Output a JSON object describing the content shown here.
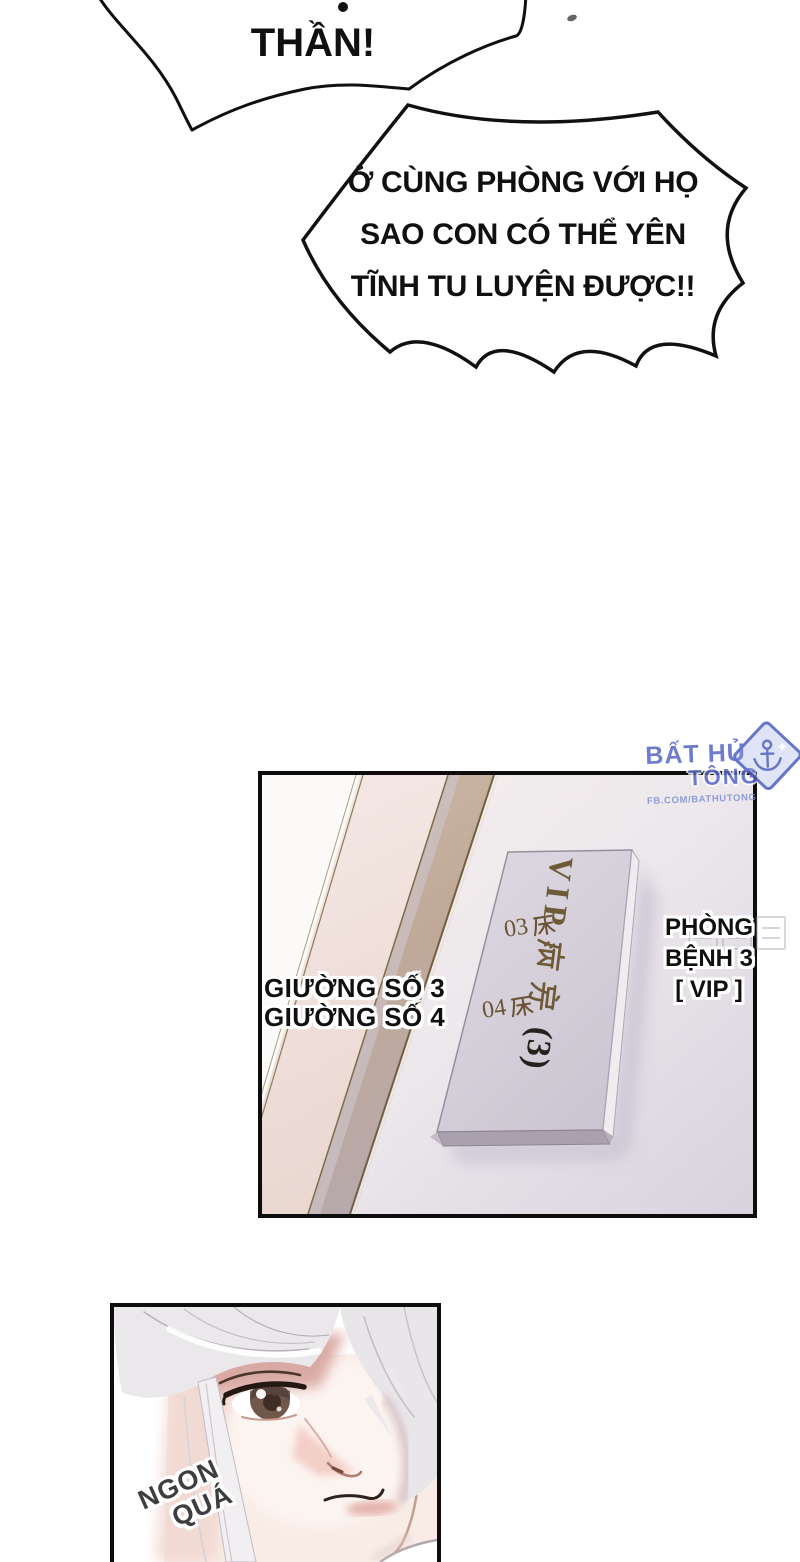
{
  "bubbles": {
    "shout": {
      "text": "THẦN!"
    },
    "burst": {
      "line1": "Ở CÙNG PHÒNG VỚI HỌ",
      "line2": "SAO CON CÓ THỂ YÊN",
      "line3": "TĨNH TU LUYỆN ĐƯỢC!!"
    }
  },
  "door_panel": {
    "sign": {
      "vip": "VIP",
      "number": "(3)",
      "bed1_num": "03",
      "bed2_num": "04",
      "full_sign_text": "VIP病房(3)",
      "bed_labels": [
        "03床",
        "04床"
      ]
    },
    "caption_left": {
      "line1": "GIƯỜNG SỐ 3",
      "line2": "GIƯỜNG SỐ 4"
    },
    "caption_right": {
      "line1": "PHÒNG",
      "line2": "BỆNH 3",
      "line3": "[ VIP ]"
    }
  },
  "watermark": {
    "name1": "BẤT HỦ",
    "name2": "TÔNG",
    "url": "FB.COM/BATHUTONG"
  },
  "face_panel": {
    "sfx1": "NGON",
    "sfx2": "QUÁ"
  },
  "colors": {
    "ink": "#101010",
    "watermark_blue": "#5565c5",
    "sign_text_brown": "#6e5a36",
    "sfx_gray": "#3e3e41",
    "panel_bg_lavender": "#dcd7e0",
    "door_tan": "#c0a997",
    "hair_silver": "#ebe8ec",
    "skin": "#f9ece7",
    "forehead_shadow": "#d8a7a1",
    "iris_brown": "#6f574a"
  }
}
